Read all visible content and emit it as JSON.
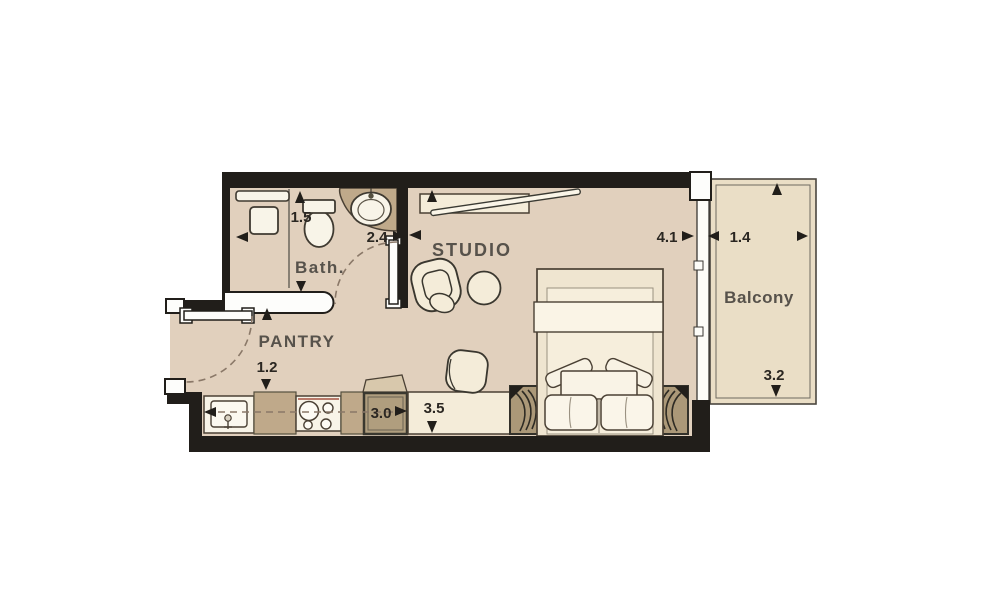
{
  "plan": {
    "rooms": {
      "studio": {
        "label": "STUDIO"
      },
      "bath": {
        "label": "Bath."
      },
      "pantry": {
        "label": "PANTRY"
      },
      "balcony": {
        "label": "Balcony"
      }
    },
    "dims": {
      "bath_depth": {
        "value": "1.5"
      },
      "bath_width": {
        "value": "2.4"
      },
      "studio_width": {
        "value": "4.1"
      },
      "balcony_width": {
        "value": "1.4"
      },
      "balcony_depth": {
        "value": "3.2"
      },
      "entry_width": {
        "value": "1.2"
      },
      "kitchen_run": {
        "value": "3.0"
      },
      "studio_depth": {
        "value": "3.5"
      }
    },
    "colors": {
      "wall": "#211e1a",
      "floor": "#e1d0bd",
      "balcony_floor": "#eadec6",
      "counter": "#bfa98a",
      "appliance": "#b09e7e",
      "furniture": "#f4ecd9",
      "fixture": "#f8f4e8",
      "nightstand": "#ab9878",
      "room_label": "#57524b",
      "dim_label": "#2b2722",
      "dash": "#8a7868"
    }
  }
}
